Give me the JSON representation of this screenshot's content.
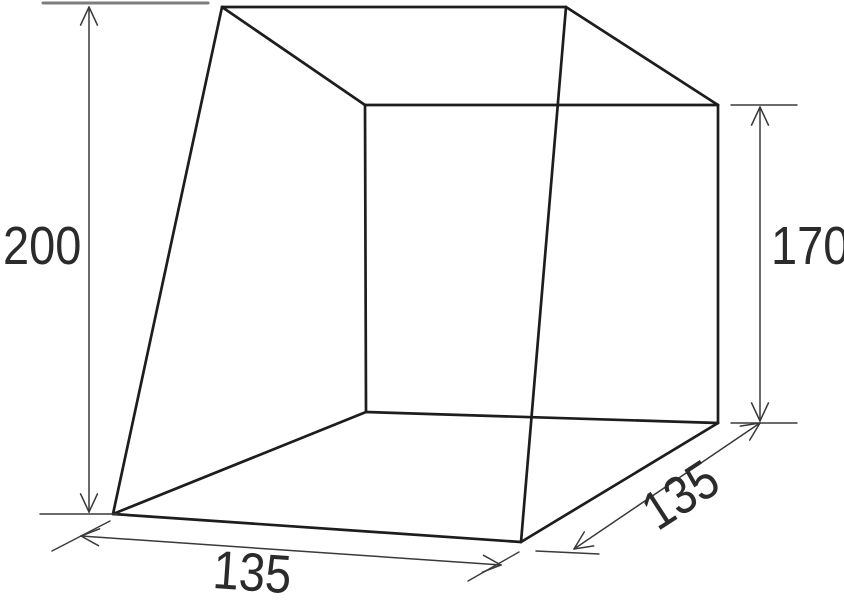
{
  "diagram": {
    "type": "dimensioned-wireframe",
    "subject": "trapezoidal tent-like box, 3d wireframe with CAD dimension lines",
    "background_color": "#ffffff",
    "style": {
      "edge_color": "#1d1d1d",
      "edge_width": 2.7,
      "dim_color": "#3a3a3a",
      "dim_width": 1.5,
      "ext_width": 1.4,
      "arrow_len": 20,
      "arrow_half_angle_deg": 25,
      "label_color": "#2b2b2b"
    },
    "vertices": {
      "A": [
        222,
        7
      ],
      "B": [
        566,
        7
      ],
      "C": [
        718,
        105
      ],
      "D": [
        365,
        105
      ],
      "E": [
        113,
        514
      ],
      "F": [
        521,
        542
      ],
      "G": [
        718,
        423
      ],
      "H": [
        366,
        412
      ]
    },
    "edges": [
      [
        "A",
        "B"
      ],
      [
        "B",
        "C"
      ],
      [
        "C",
        "D"
      ],
      [
        "D",
        "A"
      ],
      [
        "E",
        "F"
      ],
      [
        "F",
        "G"
      ],
      [
        "G",
        "H"
      ],
      [
        "H",
        "E"
      ],
      [
        "A",
        "E"
      ],
      [
        "B",
        "F"
      ],
      [
        "C",
        "G"
      ],
      [
        "D",
        "H"
      ]
    ],
    "dimensions": [
      {
        "id": "height-left",
        "value": "200",
        "dim_line": [
          89,
          7,
          89,
          512
        ],
        "arrows": [
          [
            89,
            7,
            -90
          ],
          [
            89,
            512,
            90
          ]
        ],
        "ext_lines": [
          [
            43,
            3,
            208,
            3,
            3,
            "#7d7d7d"
          ],
          [
            40,
            514,
            118,
            514
          ]
        ]
      },
      {
        "id": "height-right",
        "value": "170",
        "dim_line": [
          760,
          107,
          760,
          421
        ],
        "arrows": [
          [
            760,
            107,
            -90
          ],
          [
            760,
            421,
            90
          ]
        ],
        "ext_lines": [
          [
            731,
            105,
            797,
            105
          ],
          [
            731,
            423,
            797,
            423
          ]
        ]
      },
      {
        "id": "width-front",
        "value": "135",
        "dim_line": [
          81,
          536,
          501,
          565
        ],
        "arrows": [
          [
            81,
            536,
            184
          ],
          [
            501,
            565,
            4
          ]
        ],
        "ext_lines": [
          [
            52,
            551,
            110,
            521
          ],
          [
            468,
            581,
            519,
            552
          ]
        ]
      },
      {
        "id": "depth-right",
        "value": "135",
        "dim_line": [
          574,
          549,
          760,
          423
        ],
        "arrows": [
          [
            574,
            549,
            146
          ],
          [
            760,
            423,
            -34
          ]
        ],
        "ext_lines": [
          [
            536,
            551,
            599,
            554
          ]
        ]
      }
    ]
  }
}
